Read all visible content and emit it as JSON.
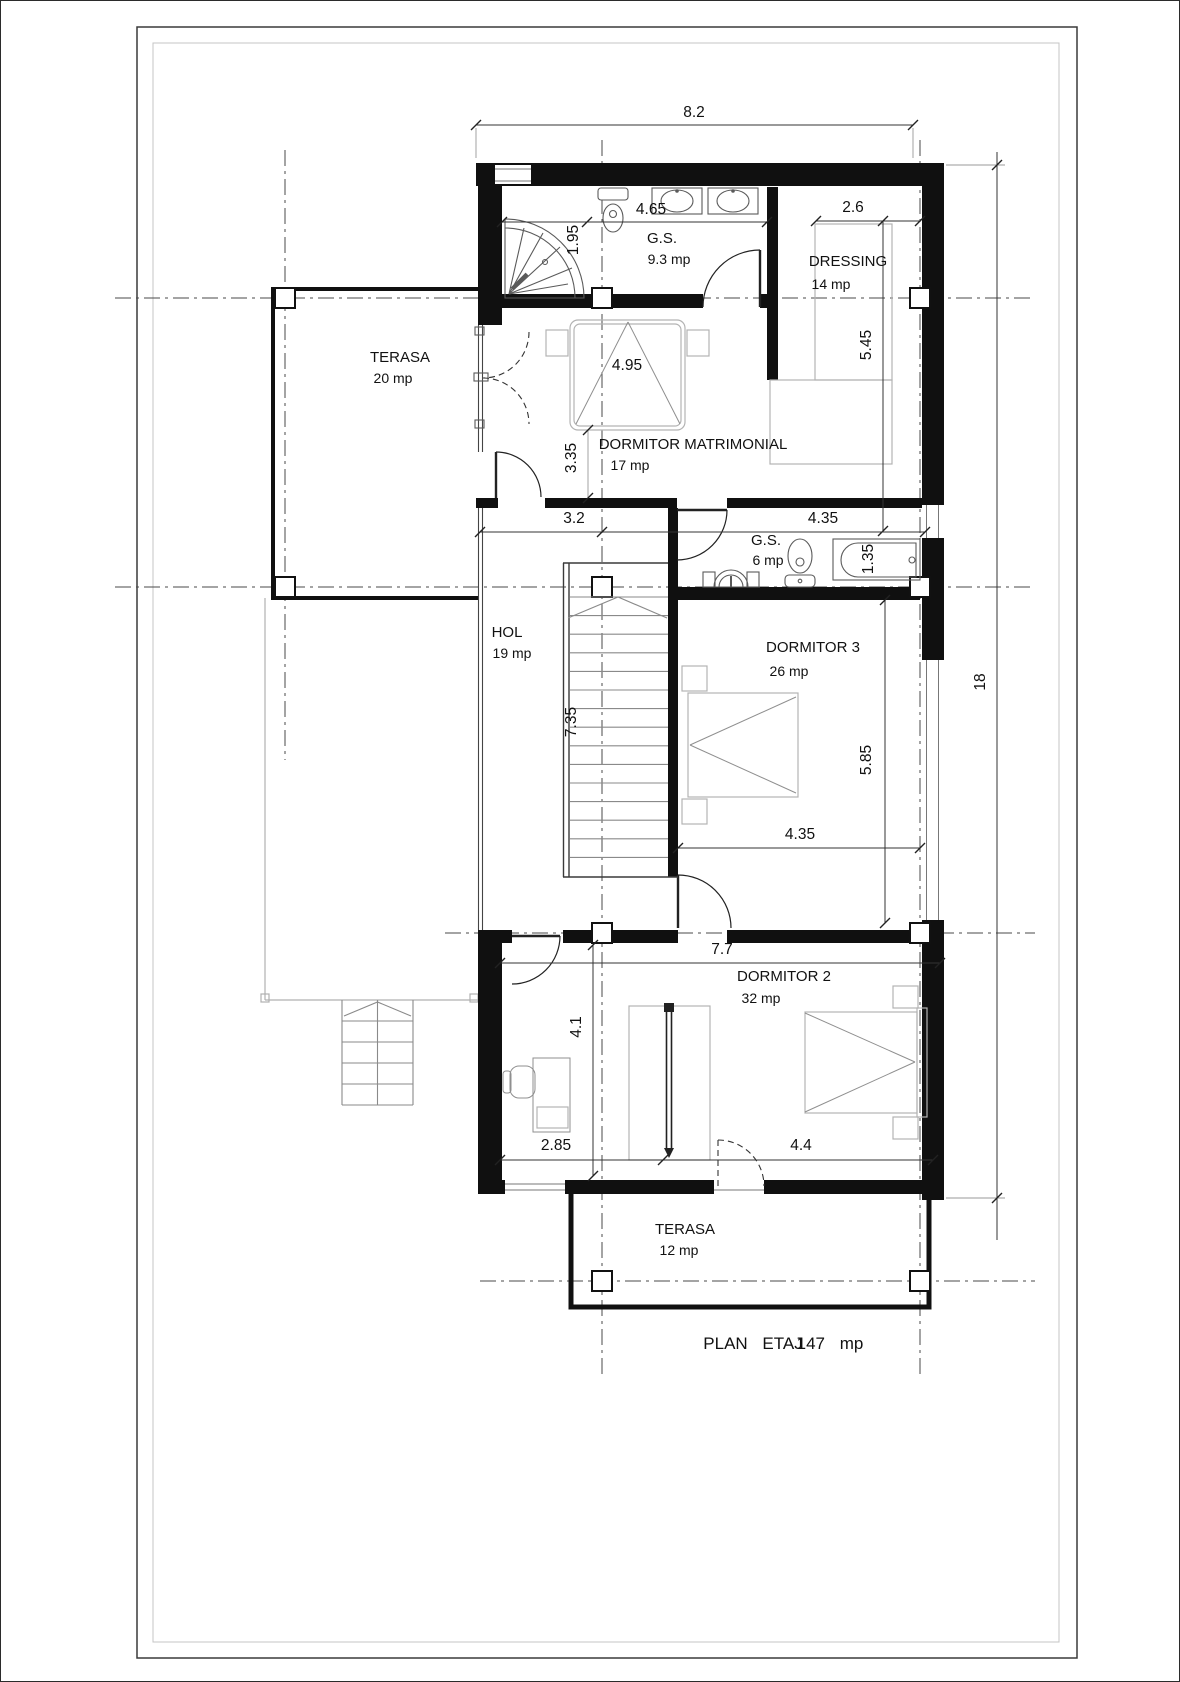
{
  "title": {
    "label": "PLAN  ETAJ",
    "area": "147 mp"
  },
  "rooms": {
    "terasa20": {
      "name": "TERASA",
      "area": "20 mp"
    },
    "gs93": {
      "name": "G.S.",
      "area": "9.3 mp"
    },
    "dressing": {
      "name": "DRESSING",
      "area": "14 mp"
    },
    "matrimonial": {
      "name": "DORMITOR MATRIMONIAL",
      "area": "17 mp"
    },
    "hol": {
      "name": "HOL",
      "area": "19 mp"
    },
    "gs6": {
      "name": "G.S.",
      "area": "6 mp"
    },
    "dormitor3": {
      "name": "DORMITOR  3",
      "area": "26 mp"
    },
    "dormitor2": {
      "name": "DORMITOR  2",
      "area": "32 mp"
    },
    "terasa12": {
      "name": "TERASA",
      "area": "12 mp"
    }
  },
  "dimensions": {
    "top_width": "8.2",
    "gs_width": "4.65",
    "shower_depth": "1.95",
    "dressing_width": "2.6",
    "dressing_height": "5.45",
    "matrimonial_bed": "4.95",
    "matrimonial_height": "3.35",
    "hol_width": "3.2",
    "gs6_width": "4.35",
    "tub_width": "1.35",
    "stair_run": "7.35",
    "dorm3_height": "5.85",
    "dorm3_width": "4.35",
    "total_height": "18",
    "dorm2_width": "7.7",
    "dorm2_height": "4.1",
    "desk_side": "2.85",
    "bed_side": "4.4"
  }
}
